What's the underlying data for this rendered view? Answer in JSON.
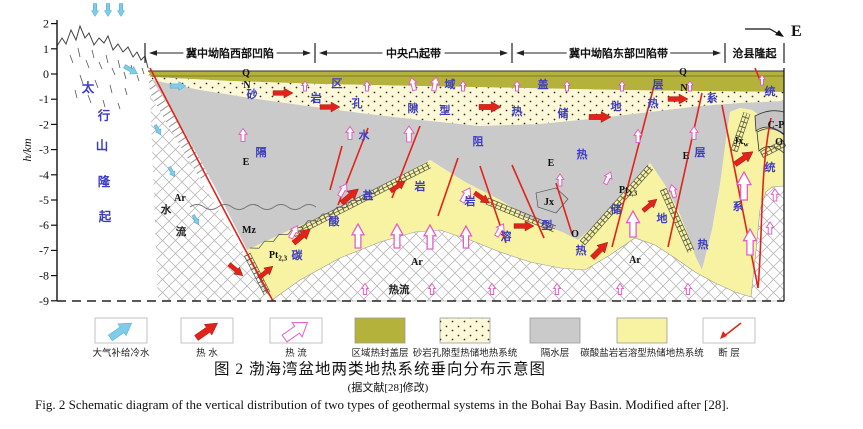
{
  "colors": {
    "red": "#e2231a",
    "pink": "#e45fc4",
    "blue": "#7ecbea",
    "tblue": "#3d3dc2",
    "olive": "#b5b23c",
    "sand": "#fcf8d8",
    "grey": "#cacaca",
    "yellow": "#f7f3a3",
    "ink": "#1a1a1a"
  },
  "header": {
    "zones": [
      {
        "label": "冀中坳陷西部凹陷",
        "x1": 145,
        "x2": 315
      },
      {
        "label": "中央凸起带",
        "x1": 315,
        "x2": 512
      },
      {
        "label": "冀中坳陷东部凹陷带",
        "x1": 512,
        "x2": 725
      },
      {
        "label": "沧县隆起",
        "x1": 725,
        "x2": 784
      }
    ],
    "direction_label": "E"
  },
  "axis": {
    "label": "h/km",
    "ticks": [
      2,
      1,
      0,
      -1,
      -2,
      -3,
      -4,
      -5,
      -6,
      -7,
      -8,
      -9
    ]
  },
  "labels": [
    {
      "t": "太",
      "x": 88,
      "y": 92,
      "cls": "lb-mt"
    },
    {
      "t": "行",
      "x": 104,
      "y": 120,
      "cls": "lb-mt"
    },
    {
      "t": "山",
      "x": 102,
      "y": 150,
      "cls": "lb-mt"
    },
    {
      "t": "隆",
      "x": 104,
      "y": 186,
      "cls": "lb-mt"
    },
    {
      "t": "起",
      "x": 105,
      "y": 221,
      "cls": "lb-mt"
    },
    {
      "t": "区",
      "x": 337,
      "y": 87,
      "cls": "lb-ph"
    },
    {
      "t": "域",
      "x": 450,
      "y": 88,
      "cls": "lb-ph"
    },
    {
      "t": "盖",
      "x": 543,
      "y": 88,
      "cls": "lb-ph"
    },
    {
      "t": "层",
      "x": 658,
      "y": 88,
      "cls": "lb-ph"
    },
    {
      "t": "砂",
      "x": 252,
      "y": 98,
      "cls": "lb-ph"
    },
    {
      "t": "岩",
      "x": 316,
      "y": 102,
      "cls": "lb-ph"
    },
    {
      "t": "孔",
      "x": 357,
      "y": 107,
      "cls": "lb-ph"
    },
    {
      "t": "隙",
      "x": 413,
      "y": 112,
      "cls": "lb-ph"
    },
    {
      "t": "型",
      "x": 445,
      "y": 114,
      "cls": "lb-ph"
    },
    {
      "t": "热",
      "x": 517,
      "y": 115,
      "cls": "lb-ph"
    },
    {
      "t": "储",
      "x": 563,
      "y": 117,
      "cls": "lb-ph"
    },
    {
      "t": "地",
      "x": 616,
      "y": 110,
      "cls": "lb-ph"
    },
    {
      "t": "热",
      "x": 653,
      "y": 107,
      "cls": "lb-ph"
    },
    {
      "t": "系",
      "x": 712,
      "y": 102,
      "cls": "lb-ph"
    },
    {
      "t": "统",
      "x": 770,
      "y": 95,
      "cls": "lb-ph"
    },
    {
      "t": "隔",
      "x": 261,
      "y": 156,
      "cls": "lb-ph"
    },
    {
      "t": "水",
      "x": 364,
      "y": 139,
      "cls": "lb-ph"
    },
    {
      "t": "阻",
      "x": 478,
      "y": 145,
      "cls": "lb-ph"
    },
    {
      "t": "热",
      "x": 582,
      "y": 158,
      "cls": "lb-ph"
    },
    {
      "t": "层",
      "x": 700,
      "y": 156,
      "cls": "lb-ph"
    },
    {
      "t": "碳",
      "x": 297,
      "y": 259,
      "cls": "lb-ph"
    },
    {
      "t": "酸",
      "x": 334,
      "y": 225,
      "cls": "lb-ph"
    },
    {
      "t": "盐",
      "x": 368,
      "y": 199,
      "cls": "lb-ph"
    },
    {
      "t": "岩",
      "x": 420,
      "y": 190,
      "cls": "lb-ph"
    },
    {
      "t": "岩",
      "x": 470,
      "y": 205,
      "cls": "lb-ph"
    },
    {
      "t": "溶",
      "x": 506,
      "y": 240,
      "cls": "lb-ph"
    },
    {
      "t": "型",
      "x": 547,
      "y": 229,
      "cls": "lb-ph"
    },
    {
      "t": "热",
      "x": 581,
      "y": 254,
      "cls": "lb-ph"
    },
    {
      "t": "储",
      "x": 616,
      "y": 213,
      "cls": "lb-ph"
    },
    {
      "t": "地",
      "x": 662,
      "y": 222,
      "cls": "lb-ph"
    },
    {
      "t": "热",
      "x": 703,
      "y": 248,
      "cls": "lb-ph"
    },
    {
      "t": "系",
      "x": 738,
      "y": 210,
      "cls": "lb-ph"
    },
    {
      "t": "统",
      "x": 770,
      "y": 171,
      "cls": "lb-ph"
    },
    {
      "t": "Q",
      "x": 246,
      "y": 76,
      "cls": "lb-st"
    },
    {
      "t": "N",
      "x": 247,
      "y": 88,
      "cls": "lb-st"
    },
    {
      "t": "Q",
      "x": 683,
      "y": 75,
      "cls": "lb-st"
    },
    {
      "t": "N",
      "x": 684,
      "y": 91,
      "cls": "lb-st"
    },
    {
      "t": "E",
      "x": 246,
      "y": 165,
      "cls": "lb-st"
    },
    {
      "t": "E",
      "x": 551,
      "y": 166,
      "cls": "lb-st"
    },
    {
      "t": "E",
      "x": 686,
      "y": 159,
      "cls": "lb-st"
    },
    {
      "t": "Mz",
      "x": 249,
      "y": 233,
      "cls": "lb-st"
    },
    {
      "t": "Ar",
      "x": 180,
      "y": 201,
      "cls": "lb-st"
    },
    {
      "t": "Ar",
      "x": 417,
      "y": 265,
      "cls": "lb-st"
    },
    {
      "t": "Ar",
      "x": 635,
      "y": 263,
      "cls": "lb-st"
    },
    {
      "t": "Pt",
      "sub": "2,3",
      "x": 278,
      "y": 258,
      "cls": "lb-st"
    },
    {
      "t": "Pt",
      "sub": "2,3",
      "x": 628,
      "y": 193,
      "cls": "lb-st"
    },
    {
      "t": "Jx",
      "x": 549,
      "y": 205,
      "cls": "lb-st"
    },
    {
      "t": "Jx",
      "sub": "w",
      "x": 741,
      "y": 144,
      "cls": "lb-st"
    },
    {
      "t": "C-P",
      "x": 776,
      "y": 128,
      "cls": "lb-st"
    },
    {
      "t": "O",
      "x": 779,
      "y": 145,
      "cls": "lb-st"
    },
    {
      "t": "O",
      "x": 575,
      "y": 237,
      "cls": "lb-st"
    },
    {
      "t": "水",
      "x": 166,
      "y": 213,
      "cls": "lb-bk"
    },
    {
      "t": "流",
      "x": 181,
      "y": 235,
      "cls": "lb-bk"
    },
    {
      "t": "热流",
      "x": 399,
      "y": 293,
      "cls": "lb-bk"
    }
  ],
  "arrows": {
    "red": [
      [
        283,
        93,
        90,
        20
      ],
      [
        330,
        107,
        90,
        20
      ],
      [
        490,
        107,
        90,
        22
      ],
      [
        600,
        117,
        90,
        22
      ],
      [
        678,
        99,
        90,
        20
      ],
      [
        350,
        196,
        50,
        22
      ],
      [
        398,
        186,
        55,
        18
      ],
      [
        302,
        236,
        50,
        22
      ],
      [
        236,
        270,
        130,
        18
      ],
      [
        266,
        272,
        50,
        18
      ],
      [
        482,
        198,
        125,
        18
      ],
      [
        524,
        226,
        90,
        20
      ],
      [
        600,
        250,
        45,
        22
      ],
      [
        650,
        205,
        50,
        18
      ],
      [
        744,
        158,
        55,
        22
      ]
    ],
    "pink": [
      [
        305,
        86,
        0,
        10
      ],
      [
        367,
        86,
        0,
        10
      ],
      [
        463,
        86,
        0,
        10
      ],
      [
        517,
        86,
        0,
        10
      ],
      [
        567,
        86,
        0,
        10
      ],
      [
        622,
        86,
        0,
        10
      ],
      [
        690,
        86,
        0,
        10
      ],
      [
        762,
        80,
        0,
        10
      ],
      [
        413,
        84,
        -15,
        13
      ],
      [
        435,
        84,
        10,
        14
      ],
      [
        243,
        135,
        0,
        13
      ],
      [
        350,
        133,
        0,
        13
      ],
      [
        409,
        134,
        0,
        16
      ],
      [
        560,
        180,
        0,
        12
      ],
      [
        638,
        136,
        0,
        13
      ],
      [
        694,
        133,
        0,
        13
      ],
      [
        294,
        232,
        30,
        14
      ],
      [
        343,
        190,
        30,
        14
      ],
      [
        466,
        195,
        30,
        16
      ],
      [
        500,
        230,
        30,
        14
      ],
      [
        608,
        178,
        25,
        13
      ],
      [
        673,
        191,
        -15,
        13
      ],
      [
        775,
        195,
        0,
        12
      ],
      [
        770,
        228,
        0,
        12
      ],
      [
        365,
        289,
        0,
        11
      ],
      [
        432,
        289,
        0,
        11
      ],
      [
        492,
        289,
        0,
        11
      ],
      [
        557,
        289,
        0,
        11
      ],
      [
        620,
        289,
        0,
        11
      ],
      [
        688,
        289,
        0,
        11
      ]
    ],
    "pink_big": [
      [
        358,
        236,
        0,
        24
      ],
      [
        397,
        236,
        0,
        24
      ],
      [
        430,
        237,
        0,
        24
      ],
      [
        466,
        237,
        0,
        22
      ],
      [
        633,
        224,
        0,
        26
      ],
      [
        744,
        186,
        0,
        28
      ],
      [
        750,
        242,
        0,
        26
      ]
    ],
    "blue": [
      [
        95,
        10,
        180,
        13
      ],
      [
        108,
        10,
        180,
        13
      ],
      [
        121,
        10,
        180,
        13
      ],
      [
        131,
        70,
        120,
        15
      ],
      [
        178,
        86,
        90,
        16
      ],
      [
        158,
        130,
        150,
        11
      ],
      [
        172,
        172,
        150,
        11
      ],
      [
        196,
        220,
        150,
        11
      ]
    ]
  },
  "faults": [
    "M150,68 C195,155 242,245 273,301",
    "M342,146 L330,190",
    "M368,128 L338,205",
    "M420,126 L392,198",
    "M458,158 L438,216",
    "M480,166 L506,243",
    "M512,165 L544,238",
    "M556,183 L572,234",
    "M654,86 L612,247",
    "M702,93 L668,247",
    "M722,105 L758,288",
    "M758,288 C763,230 760,170 771,118",
    "M755,68 L760,80"
  ],
  "legend": {
    "items": [
      {
        "icon": "cold-water-arrow",
        "label": "大气补给冷水"
      },
      {
        "icon": "hot-water-arrow",
        "label": "热 水"
      },
      {
        "icon": "heat-flow-arrow",
        "label": "热 流"
      },
      {
        "icon": "cap-swatch",
        "label": "区域热封盖层"
      },
      {
        "icon": "sandstone-swatch",
        "label": "砂岩孔隙型热储地热系统"
      },
      {
        "icon": "aquitard-swatch",
        "label": "隔水层"
      },
      {
        "icon": "carbonate-swatch",
        "label": "碳酸盐岩岩溶型热储地热系统"
      },
      {
        "icon": "fault-symbol",
        "label": "断 层"
      }
    ]
  },
  "caption": {
    "line1": "图 2  渤海湾盆地两类地热系统垂向分布示意图",
    "line2": "(据文献[28]修改)",
    "line3": "Fig. 2  Schematic diagram of the vertical distribution of two types of geothermal systems in the Bohai Bay Basin. Modified after [28]."
  }
}
